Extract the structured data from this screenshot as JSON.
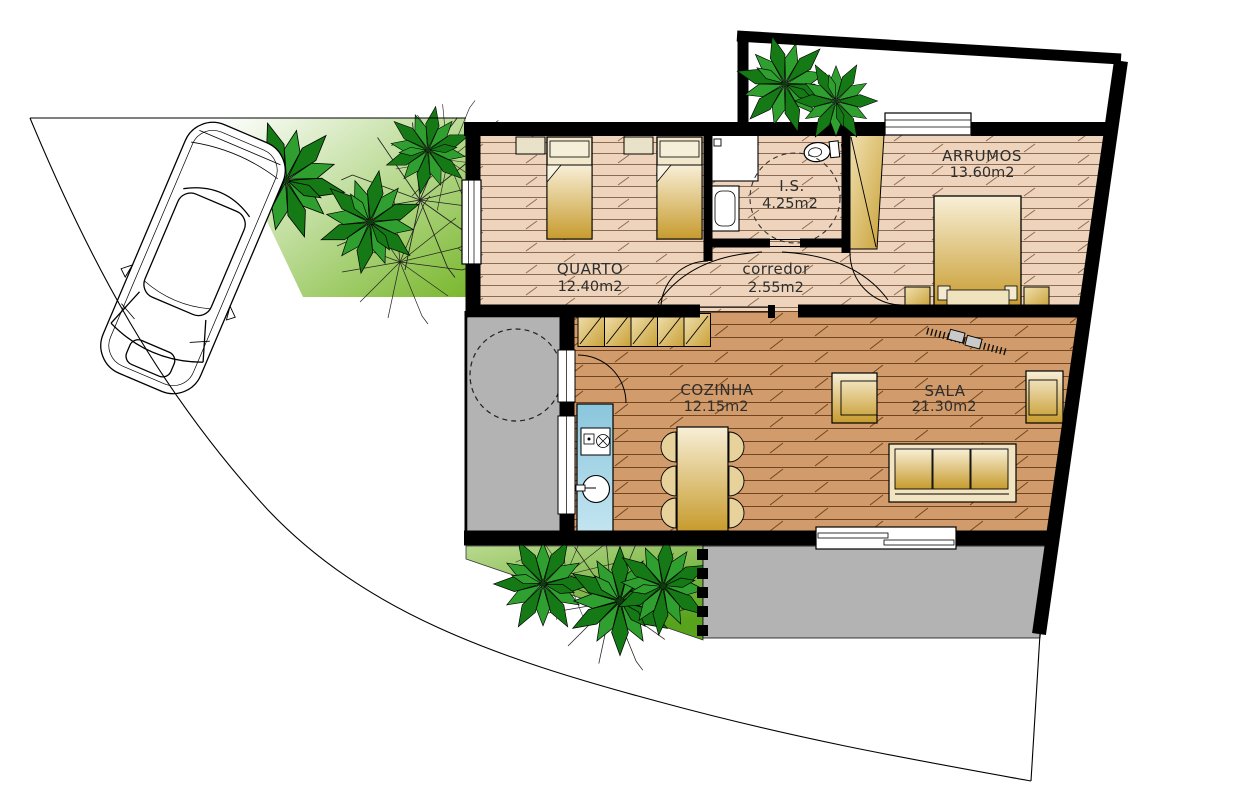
{
  "drawing_type": "residential floor plan with site, car and gardens",
  "rooms": [
    {
      "name": "QUARTO",
      "area": "12.40m2"
    },
    {
      "name": "I.S.",
      "area": "4.25m2"
    },
    {
      "name": "corredor",
      "area": "2.55m2"
    },
    {
      "name": "ARRUMOS",
      "area": "13.60m2"
    },
    {
      "name": "COZINHA",
      "area": "12.15m2"
    },
    {
      "name": "SALA",
      "area": "21.30m2"
    }
  ],
  "colors": {
    "walls": "#000000",
    "floor_light_wood": "#eed4bc",
    "floor_dark_wood": "#d19b6b",
    "furniture_gold": "#c79b2d",
    "kitchen_counter_blue": "#9fd0e4",
    "patio_gray": "#b3b3b3",
    "garden_green": "#5ca81f",
    "palm_dark_green": "#157a15",
    "palm_light_green": "#2fa02f"
  }
}
